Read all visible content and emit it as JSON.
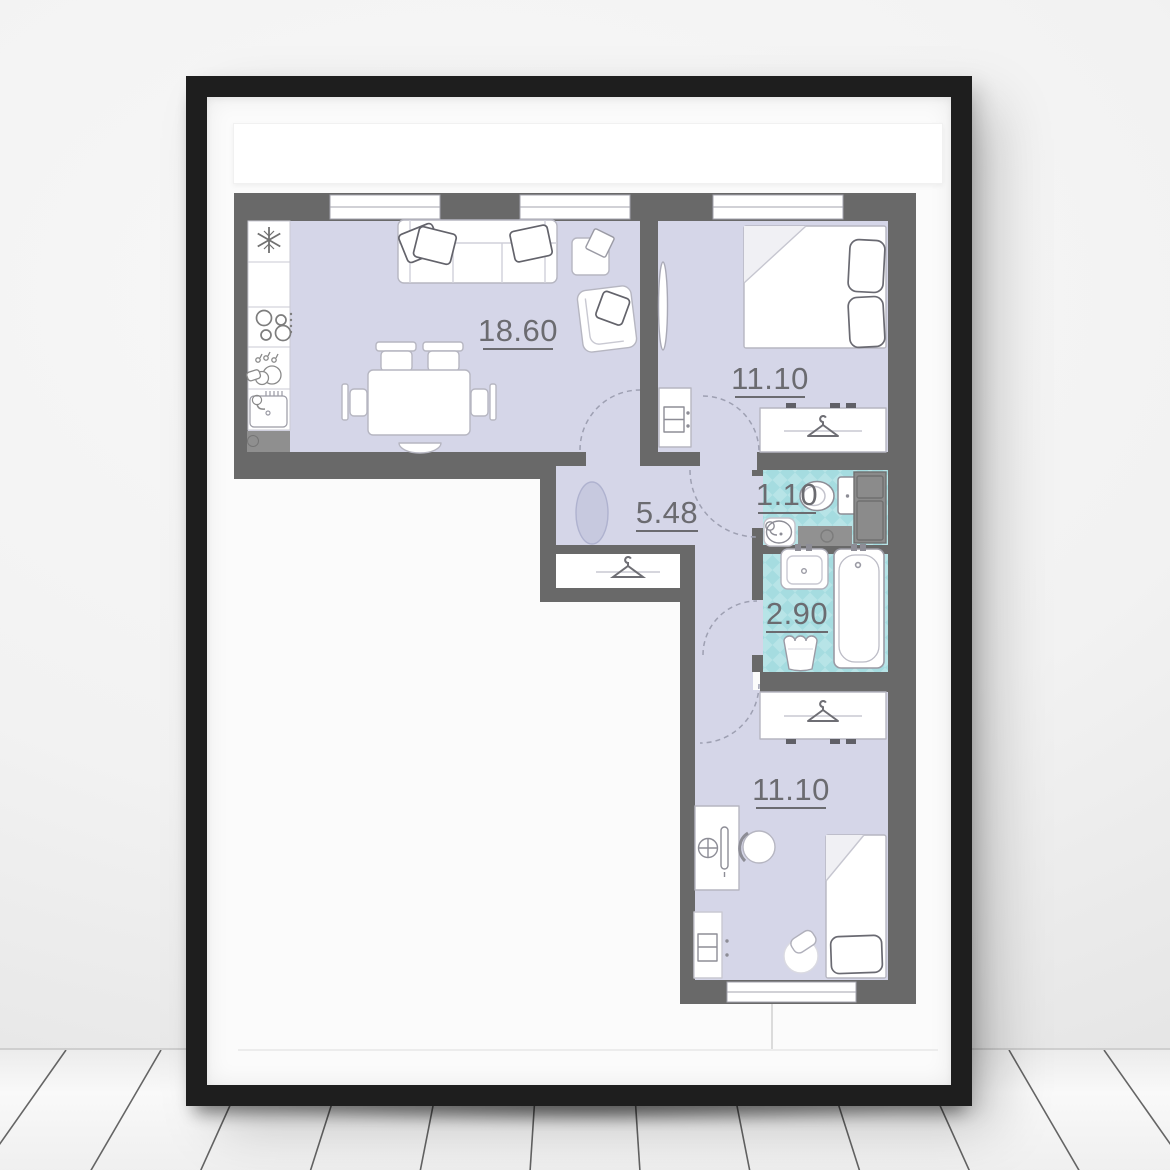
{
  "poster": {
    "type": "framed apartment floor plan poster",
    "rooms": {
      "living_kitchen": {
        "area": "18.60"
      },
      "bedroom_top": {
        "area": "11.10"
      },
      "hallway": {
        "area": "5.48"
      },
      "wc": {
        "area": "1.10"
      },
      "bathroom": {
        "area": "2.90"
      },
      "bedroom_bottom": {
        "area": "11.10"
      }
    },
    "colors": {
      "frame": "#1e1e1e",
      "mat": "#fbfbfb",
      "plan_walls": "#696969",
      "room_fill": "#d5d6e8",
      "tile_base": "#b7e4e7",
      "tile_diamond": "#a5dce0",
      "hall_rug": "#c7c9df",
      "label_text": "#6b6b70",
      "wall_paint": "#f2f2f2",
      "floor_boards": "#f1f1f1"
    },
    "icons": [
      "snowflake-icon",
      "cooktop-icon",
      "dishes-icon",
      "sink-icon",
      "hanger-icon",
      "toilet-icon",
      "washbasin-icon",
      "bathtub-icon",
      "laundry-basket-icon",
      "monitor-icon",
      "door-arc-icon",
      "window-icon"
    ]
  }
}
